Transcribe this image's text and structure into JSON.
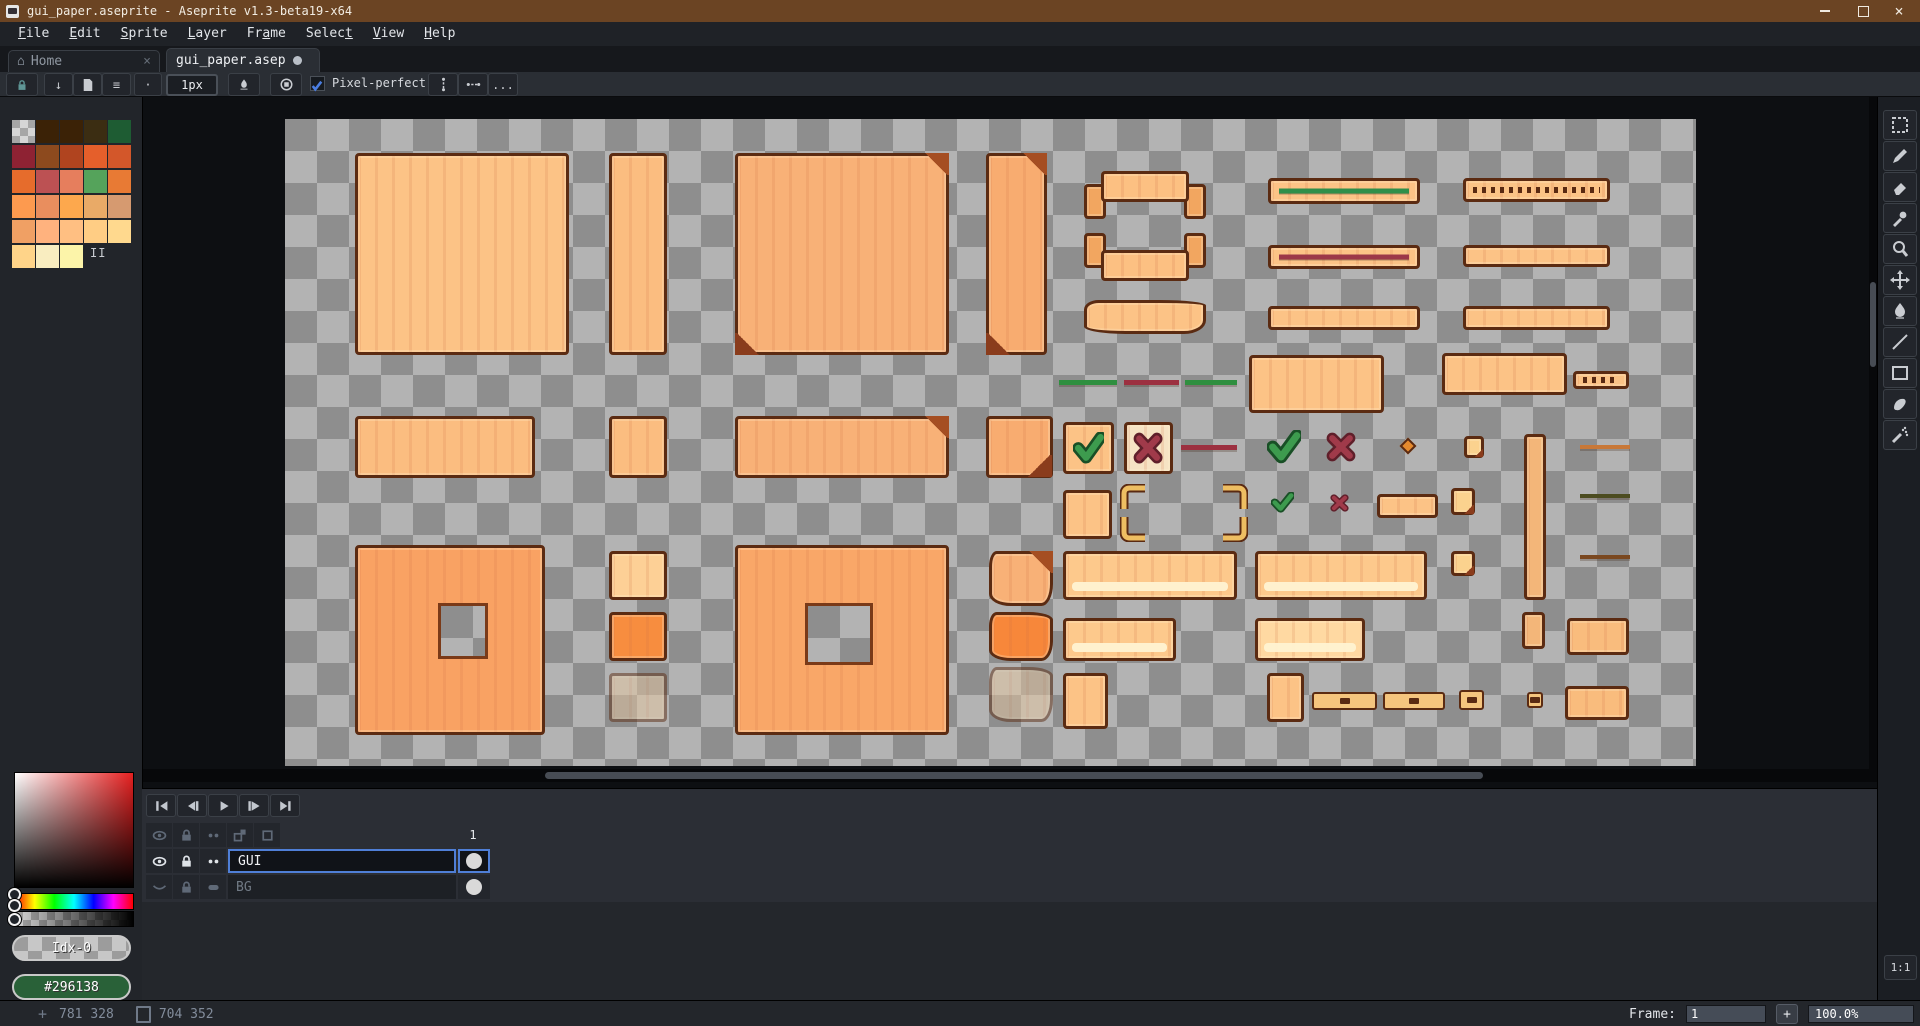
{
  "window": {
    "title": "gui_paper.aseprite - Aseprite v1.3-beta19-x64"
  },
  "menu": {
    "items": [
      {
        "label": "File",
        "underline": 0
      },
      {
        "label": "Edit",
        "underline": 0
      },
      {
        "label": "Sprite",
        "underline": 0
      },
      {
        "label": "Layer",
        "underline": 0
      },
      {
        "label": "Frame",
        "underline": 2
      },
      {
        "label": "Select",
        "underline": 5
      },
      {
        "label": "View",
        "underline": 0
      },
      {
        "label": "Help",
        "underline": 0
      }
    ]
  },
  "tabs": [
    {
      "label": "Home",
      "active": false
    },
    {
      "label": "gui_paper.asep",
      "active": true,
      "modified": true
    }
  ],
  "toolbar": {
    "brush_size": "1px",
    "pixel_perfect": "Pixel-perfect",
    "more": "..."
  },
  "palette": {
    "rows": [
      [
        "checker",
        "#3b2206",
        "#3b2206",
        "#3b2d12",
        "#1e5c33"
      ],
      [
        "#8e2233",
        "#8d4a1e",
        "#b0441f",
        "#e55f2b",
        "#d3572a"
      ],
      [
        "#e66c2c",
        "#bc5153",
        "#e67e5d",
        "#55a35b",
        "#e87a34"
      ],
      [
        "#fd9a4f",
        "#e98e5e",
        "#fda84d",
        "#e9aa67",
        "#d69a70"
      ],
      [
        "#f0a064",
        "#ffb27e",
        "#ffbf82",
        "#ffcd84",
        "#ffd98e"
      ],
      [
        "#ffd489",
        "#f9edc0",
        "#fcf4a9",
        null,
        null
      ]
    ],
    "index_label": "II"
  },
  "picker": {
    "index_label": "Idx-0",
    "hex": "#296138",
    "hex_color": "#296138"
  },
  "tools": [
    "rectangular-marquee",
    "pencil",
    "eraser",
    "eyedropper",
    "zoom",
    "move",
    "paint-bucket",
    "line",
    "rectangle",
    "contour",
    "spray"
  ],
  "timeline": {
    "frame_header": "1",
    "playback": [
      "go-first",
      "prev-frame",
      "play",
      "next-frame",
      "go-last"
    ],
    "header_icons": [
      "eye",
      "lock",
      "dots",
      "onion",
      "cel"
    ],
    "layers": [
      {
        "name": "GUI",
        "icons": [
          "eye-open",
          "lock",
          "dots"
        ],
        "selected": true,
        "dim": false
      },
      {
        "name": "BG",
        "icons": [
          "eye-closed",
          "lock",
          "capsule"
        ],
        "selected": false,
        "dim": true
      }
    ]
  },
  "status": {
    "position": "781 328",
    "sprite_size": "704 352",
    "frame_label": "Frame:",
    "frame_value": "1",
    "add_frame": "+",
    "zoom": "100.0%",
    "pixel_ratio": "1:1"
  },
  "colors": {
    "title_brown": "#6b4423",
    "accent_blue": "#4f7fd7",
    "canvas_check_light": "#b3b3b3",
    "canvas_check_dark": "#8e8e8e",
    "paper_outline": "#5b2b12"
  },
  "canvas": {
    "sprites": [
      {
        "name": "paper-panel-large",
        "type": "paper",
        "x": 70,
        "y": 34,
        "w": 214,
        "h": 202,
        "fill": "#fcc386"
      },
      {
        "name": "paper-strip-tall",
        "type": "paper",
        "x": 324,
        "y": 34,
        "w": 58,
        "h": 202,
        "fill": "#fbbd80"
      },
      {
        "name": "paper-panel-folded",
        "type": "paper",
        "x": 450,
        "y": 34,
        "w": 214,
        "h": 202,
        "fill": "#f8b177",
        "fold": "tr",
        "curl": true
      },
      {
        "name": "paper-strip-folded",
        "type": "paper",
        "x": 701,
        "y": 34,
        "w": 61,
        "h": 202,
        "fill": "#f8ac70",
        "fold": "tr",
        "curl": true
      },
      {
        "name": "ribbon-tabs-down",
        "type": "ribbon",
        "x": 799,
        "y": 52,
        "w": 122,
        "h": 48,
        "dir": "down"
      },
      {
        "name": "ribbon-tabs-up",
        "type": "ribbon",
        "x": 799,
        "y": 114,
        "w": 122,
        "h": 48,
        "dir": "up"
      },
      {
        "name": "banner-plain",
        "type": "paper",
        "x": 799,
        "y": 181,
        "w": 122,
        "h": 34,
        "fill": "#fcc386",
        "ragged": true
      },
      {
        "name": "progressbar-green",
        "type": "bar",
        "x": 983,
        "y": 59,
        "w": 152,
        "h": 26,
        "line": "#2f8f4a"
      },
      {
        "name": "progressbar-red",
        "type": "bar",
        "x": 983,
        "y": 126,
        "w": 152,
        "h": 24,
        "line": "#9c3848"
      },
      {
        "name": "progressbar-empty",
        "type": "bar",
        "x": 983,
        "y": 187,
        "w": 152,
        "h": 24
      },
      {
        "name": "progressbar-ticks",
        "type": "bar",
        "x": 1178,
        "y": 59,
        "w": 147,
        "h": 24,
        "ticks": true
      },
      {
        "name": "progressbar-empty-2",
        "type": "bar",
        "x": 1178,
        "y": 126,
        "w": 147,
        "h": 22
      },
      {
        "name": "progressbar-empty-3",
        "type": "bar",
        "x": 1178,
        "y": 187,
        "w": 147,
        "h": 24
      },
      {
        "name": "meter-line-green-1",
        "type": "line",
        "x": 774,
        "y": 261,
        "w": 58,
        "h": 5,
        "fill": "#2f8f3f"
      },
      {
        "name": "meter-line-red",
        "type": "line",
        "x": 839,
        "y": 261,
        "w": 55,
        "h": 5,
        "fill": "#9c3040"
      },
      {
        "name": "meter-line-green-2",
        "type": "line",
        "x": 900,
        "y": 261,
        "w": 52,
        "h": 5,
        "fill": "#2f8f3f"
      },
      {
        "name": "paper-label",
        "type": "paper",
        "x": 964,
        "y": 236,
        "w": 135,
        "h": 58,
        "fill": "#fcc386"
      },
      {
        "name": "paper-label-2",
        "type": "paper",
        "x": 1157,
        "y": 234,
        "w": 125,
        "h": 42,
        "fill": "#fcc386"
      },
      {
        "name": "minibar-ticks",
        "type": "bar",
        "x": 1288,
        "y": 252,
        "w": 56,
        "h": 18,
        "ticks": true
      },
      {
        "name": "paper-header",
        "type": "paper",
        "x": 70,
        "y": 297,
        "w": 180,
        "h": 62,
        "fill": "#fbbd80"
      },
      {
        "name": "paper-small",
        "type": "paper",
        "x": 324,
        "y": 297,
        "w": 58,
        "h": 62,
        "fill": "#fbbd80"
      },
      {
        "name": "paper-header-folded",
        "type": "paper",
        "x": 450,
        "y": 297,
        "w": 214,
        "h": 62,
        "fill": "#f8b177",
        "fold": "tr"
      },
      {
        "name": "paper-small-folded",
        "type": "paper",
        "x": 701,
        "y": 297,
        "w": 67,
        "h": 62,
        "fill": "#f8ac70",
        "fold": "br"
      },
      {
        "name": "button-confirm",
        "type": "paper",
        "x": 778,
        "y": 303,
        "w": 51,
        "h": 52,
        "fill": "#fcc386",
        "glyph": "check"
      },
      {
        "name": "button-cancel",
        "type": "paper",
        "x": 839,
        "y": 303,
        "w": 49,
        "h": 52,
        "fill": "#f6e3c4",
        "glyph": "cross"
      },
      {
        "name": "meter-line-red-2",
        "type": "line",
        "x": 896,
        "y": 326,
        "w": 56,
        "h": 5,
        "fill": "#9c3040"
      },
      {
        "name": "icon-check-large",
        "type": "check",
        "x": 982,
        "y": 311,
        "w": 34,
        "h": 34
      },
      {
        "name": "icon-cross-large",
        "type": "cross",
        "x": 1041,
        "y": 313,
        "w": 30,
        "h": 30
      },
      {
        "name": "icon-diamond",
        "type": "diamond",
        "x": 1117,
        "y": 321,
        "w": 12,
        "h": 12
      },
      {
        "name": "sticky-note-1",
        "type": "paper",
        "x": 1179,
        "y": 317,
        "w": 20,
        "h": 22,
        "fill": "#fbd28e",
        "fold": "br"
      },
      {
        "name": "scroll-strip-tall",
        "type": "paper",
        "x": 1239,
        "y": 315,
        "w": 22,
        "h": 166,
        "fill": "#f3b679"
      },
      {
        "name": "divider-orange",
        "type": "line",
        "x": 1295,
        "y": 326,
        "w": 50,
        "h": 4,
        "fill": "#c87838"
      },
      {
        "name": "paper-square-small",
        "type": "paper",
        "x": 778,
        "y": 371,
        "w": 49,
        "h": 49,
        "fill": "#fcc386"
      },
      {
        "name": "frame-corner-tl",
        "type": "corner",
        "x": 835,
        "y": 365,
        "w": 26,
        "h": 26,
        "corner": "tl"
      },
      {
        "name": "frame-corner-tr",
        "type": "corner",
        "x": 937,
        "y": 365,
        "w": 26,
        "h": 26,
        "corner": "tr"
      },
      {
        "name": "frame-corner-bl",
        "type": "corner",
        "x": 835,
        "y": 397,
        "w": 26,
        "h": 26,
        "corner": "bl"
      },
      {
        "name": "frame-corner-br",
        "type": "corner",
        "x": 937,
        "y": 397,
        "w": 26,
        "h": 26,
        "corner": "br"
      },
      {
        "name": "icon-check-small",
        "type": "check",
        "x": 986,
        "y": 373,
        "w": 23,
        "h": 21
      },
      {
        "name": "icon-cross-small",
        "type": "cross",
        "x": 1045,
        "y": 375,
        "w": 19,
        "h": 18
      },
      {
        "name": "tab-bar-small",
        "type": "paper",
        "x": 1092,
        "y": 375,
        "w": 61,
        "h": 24,
        "fill": "#fcc386"
      },
      {
        "name": "sticky-note-2",
        "type": "paper",
        "x": 1166,
        "y": 369,
        "w": 24,
        "h": 27,
        "fill": "#fbd28e",
        "fold": "br"
      },
      {
        "name": "divider-dark",
        "type": "line",
        "x": 1295,
        "y": 375,
        "w": 50,
        "h": 4,
        "fill": "#4c4c20"
      },
      {
        "name": "slice-panel-orange",
        "type": "hole",
        "x": 70,
        "y": 426,
        "w": 190,
        "h": 190,
        "fill": "#f9a263",
        "hole": [
          80,
          55,
          50,
          56
        ]
      },
      {
        "name": "paper-chip-light",
        "type": "paper",
        "x": 324,
        "y": 432,
        "w": 58,
        "h": 49,
        "fill": "#fdd096"
      },
      {
        "name": "slice-panel-textured",
        "type": "hole",
        "x": 450,
        "y": 426,
        "w": 214,
        "h": 190,
        "fill": "#f9a768",
        "hole": [
          67,
          55,
          68,
          62
        ]
      },
      {
        "name": "paper-torn",
        "type": "paper",
        "x": 704,
        "y": 432,
        "w": 64,
        "h": 55,
        "fill": "#f8b177",
        "ragged": true,
        "fold": "tr"
      },
      {
        "name": "button-long",
        "type": "paper",
        "x": 778,
        "y": 432,
        "w": 174,
        "h": 49,
        "fill": "#fdc98c",
        "shine": true
      },
      {
        "name": "button-long-2",
        "type": "paper",
        "x": 970,
        "y": 432,
        "w": 172,
        "h": 49,
        "fill": "#fdc98c",
        "shine": true
      },
      {
        "name": "sticky-note-3",
        "type": "paper",
        "x": 1166,
        "y": 432,
        "w": 24,
        "h": 25,
        "fill": "#fbd28e",
        "fold": "br"
      },
      {
        "name": "divider-brown",
        "type": "line",
        "x": 1295,
        "y": 436,
        "w": 50,
        "h": 4,
        "fill": "#7a4820"
      },
      {
        "name": "paper-chip-orange",
        "type": "paper",
        "x": 324,
        "y": 493,
        "w": 58,
        "h": 49,
        "fill": "#f78d3f"
      },
      {
        "name": "paper-torn-orange",
        "type": "paper",
        "x": 704,
        "y": 493,
        "w": 64,
        "h": 49,
        "fill": "#f7873a",
        "ragged": true
      },
      {
        "name": "button-medium",
        "type": "paper",
        "x": 778,
        "y": 499,
        "w": 113,
        "h": 43,
        "fill": "#fdc98c",
        "shine": true
      },
      {
        "name": "button-medium-light",
        "type": "paper",
        "x": 970,
        "y": 499,
        "w": 110,
        "h": 43,
        "fill": "#ffd9a2",
        "shine": true
      },
      {
        "name": "scroll-thumb-small",
        "type": "paper",
        "x": 1237,
        "y": 493,
        "w": 23,
        "h": 37,
        "fill": "#f3b679"
      },
      {
        "name": "paper-chip-wide",
        "type": "paper",
        "x": 1282,
        "y": 499,
        "w": 62,
        "h": 37,
        "fill": "#f9bc7d"
      },
      {
        "name": "paper-chip-faded",
        "type": "paper",
        "x": 324,
        "y": 554,
        "w": 58,
        "h": 49,
        "fill": "#e8c9a2",
        "faded": true
      },
      {
        "name": "paper-torn-faded",
        "type": "paper",
        "x": 704,
        "y": 548,
        "w": 64,
        "h": 55,
        "fill": "#e8c9a2",
        "faded": true,
        "ragged": true
      },
      {
        "name": "paper-square-2",
        "type": "paper",
        "x": 778,
        "y": 554,
        "w": 45,
        "h": 56,
        "fill": "#fcc386"
      },
      {
        "name": "paper-square-3",
        "type": "paper",
        "x": 982,
        "y": 554,
        "w": 37,
        "h": 49,
        "fill": "#fcc386"
      },
      {
        "name": "slider-track-1",
        "type": "chip",
        "x": 1027,
        "y": 573,
        "w": 65,
        "h": 18,
        "dash": true
      },
      {
        "name": "slider-track-2",
        "type": "chip",
        "x": 1098,
        "y": 573,
        "w": 62,
        "h": 18,
        "dash": true
      },
      {
        "name": "slider-chip-1",
        "type": "chip",
        "x": 1174,
        "y": 571,
        "w": 25,
        "h": 20,
        "dash": true
      },
      {
        "name": "slider-chip-2",
        "type": "chip",
        "x": 1242,
        "y": 573,
        "w": 16,
        "h": 16,
        "dash": true
      },
      {
        "name": "paper-chip-3",
        "type": "paper",
        "x": 1280,
        "y": 567,
        "w": 64,
        "h": 34,
        "fill": "#f9bc7d"
      }
    ]
  }
}
